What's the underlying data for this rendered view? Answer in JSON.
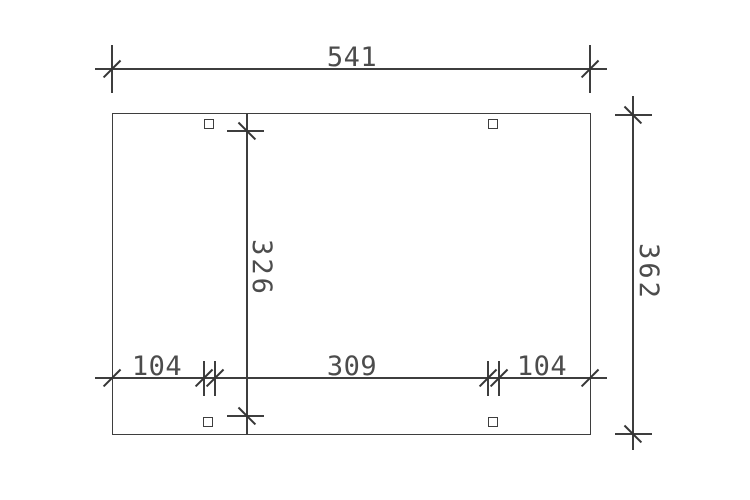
{
  "drawing": {
    "colors": {
      "line": "#3e3e3e",
      "text": "#4c4c4c",
      "background": "#ffffff"
    },
    "dimensions": {
      "overall_width": "541",
      "overall_depth": "362",
      "inner_post_depth": "326",
      "bottom_left_offset": "104",
      "bottom_post_spacing": "309",
      "bottom_right_offset": "104"
    }
  }
}
